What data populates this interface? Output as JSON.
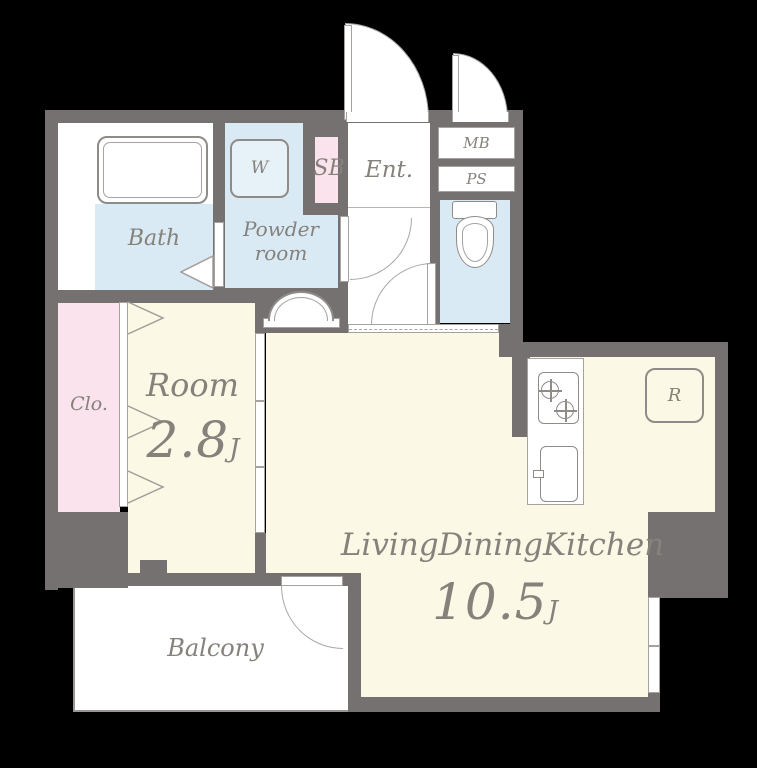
{
  "title": "apartment-floor-plan",
  "palette": {
    "background": "#000000",
    "wall": "#757170",
    "floor_cream": "#fcf8e6",
    "floor_blue": "#d9eaf4",
    "floor_pink": "#fae3ec",
    "floor_white": "#ffffff",
    "line": "#a5a2a0",
    "label_text": "#85817b"
  },
  "rooms": {
    "bath": {
      "label": "Bath"
    },
    "washer": {
      "label": "W"
    },
    "shoe_box": {
      "label": "SB"
    },
    "entrance": {
      "label": "Ent."
    },
    "meter_box": {
      "label": "MB"
    },
    "pipe_space": {
      "label": "PS"
    },
    "powder_room": {
      "line1": "Powder",
      "line2": "room"
    },
    "closet": {
      "label": "Clo."
    },
    "room": {
      "label": "Room",
      "size": "2.8",
      "unit": "J"
    },
    "ldk": {
      "label": "LivingDiningKitchen",
      "size": "10.5",
      "unit": "J"
    },
    "balcony": {
      "label": "Balcony"
    },
    "refrigerator": {
      "label": "R"
    }
  }
}
